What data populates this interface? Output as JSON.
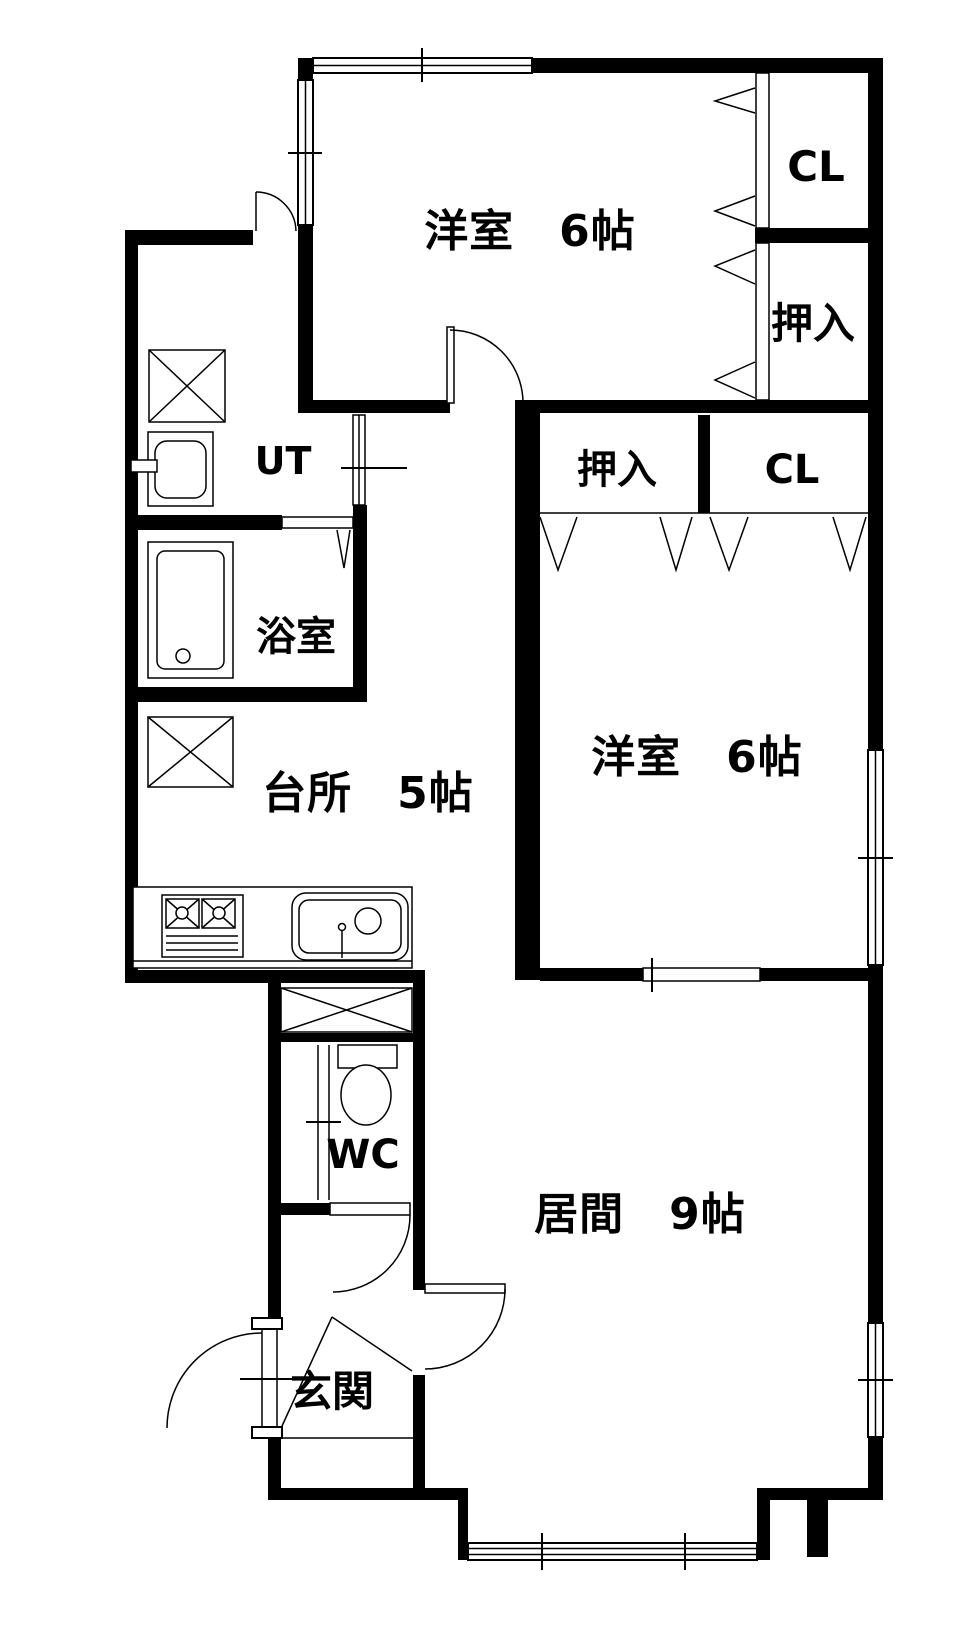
{
  "floorplan": {
    "rooms": {
      "bedroom_north": {
        "label": "洋室　6帖"
      },
      "closet_north": {
        "label": "CL"
      },
      "oshiire_north": {
        "label": "押入"
      },
      "oshiire_mid": {
        "label": "押入"
      },
      "closet_mid": {
        "label": "CL"
      },
      "utility": {
        "label": "UT"
      },
      "bathroom": {
        "label": "浴室"
      },
      "bedroom_mid": {
        "label": "洋室　6帖"
      },
      "kitchen": {
        "label": "台所　5帖"
      },
      "toilet": {
        "label": "WC"
      },
      "living": {
        "label": "居間　9帖"
      },
      "entrance": {
        "label": "玄関"
      }
    },
    "colors": {
      "wall": "#000000",
      "background": "#ffffff",
      "line": "#000000"
    }
  }
}
